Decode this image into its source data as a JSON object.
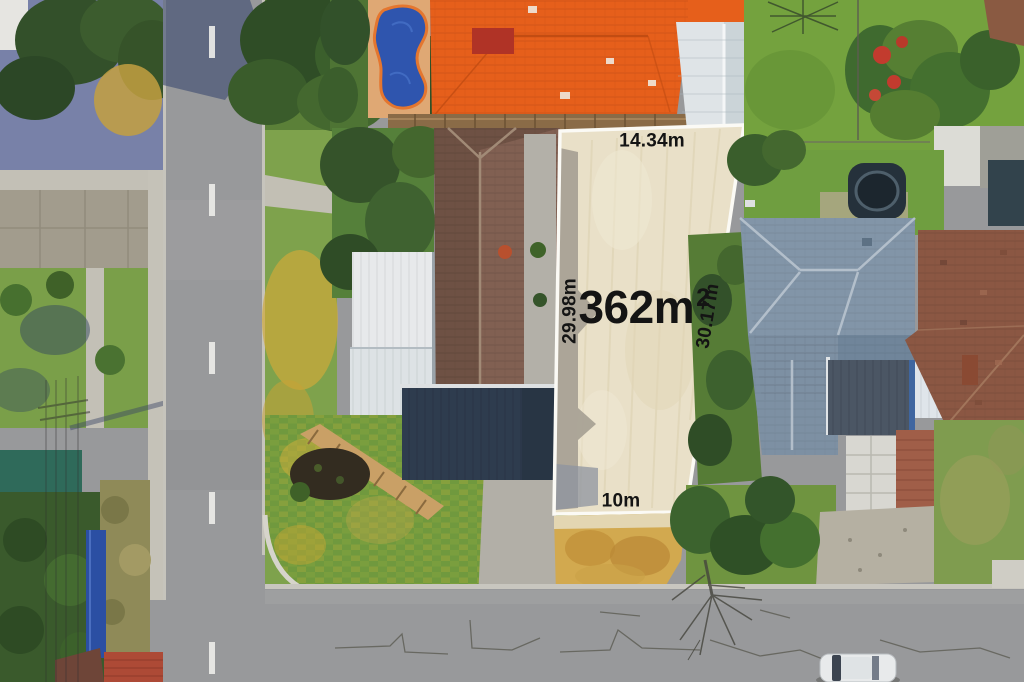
{
  "lot": {
    "area_value": "362m",
    "area_exponent": "2",
    "top_boundary_length": "14.34m",
    "left_boundary_length": "29.98m",
    "right_boundary_length": "30.17m",
    "bottom_boundary_length": "10m"
  },
  "colors": {
    "lot_sand": "#e9e0c8",
    "label_text": "#141414",
    "road": "#98999b",
    "orange_roof": "#e65f1b",
    "pool_blue": "#2f55ae",
    "blue_roof": "#8295a8",
    "brown_roof": "#6e5144"
  }
}
